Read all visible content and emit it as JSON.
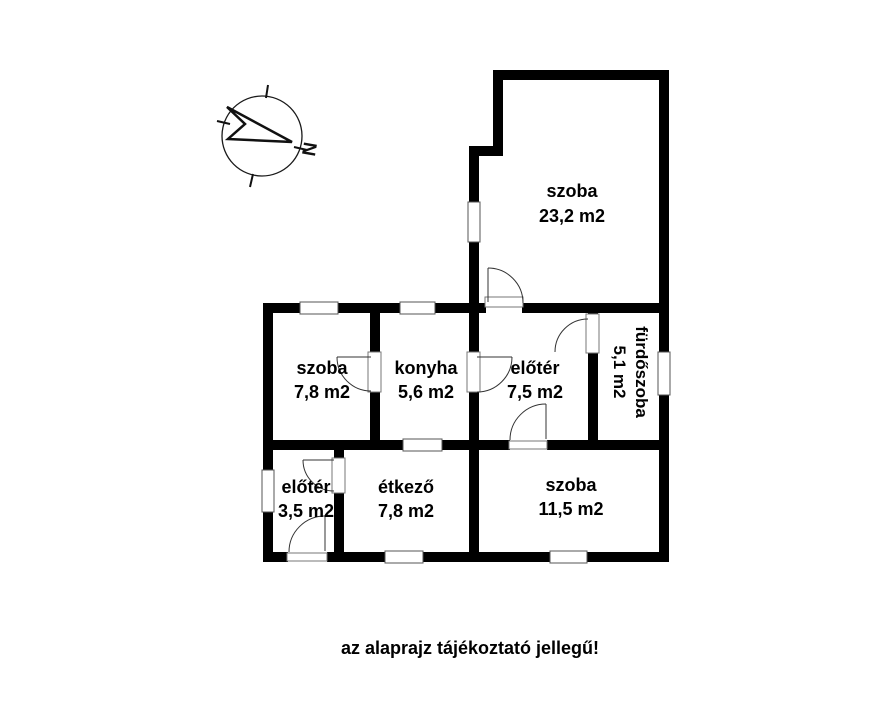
{
  "rooms": [
    {
      "id": "szoba-large",
      "name": "szoba",
      "area": "23,2 m2"
    },
    {
      "id": "szoba-small",
      "name": "szoba",
      "area": "7,8 m2"
    },
    {
      "id": "konyha",
      "name": "konyha",
      "area": "5,6 m2"
    },
    {
      "id": "eloter-upper",
      "name": "előtér",
      "area": "7,5 m2"
    },
    {
      "id": "furdoszoba",
      "name": "fürdőszoba",
      "area": "5,1 m2"
    },
    {
      "id": "eloter-lower",
      "name": "előtér",
      "area": "3,5 m2"
    },
    {
      "id": "etkezo",
      "name": "étkező",
      "area": "7,8 m2"
    },
    {
      "id": "szoba-bottom",
      "name": "szoba",
      "area": "11,5 m2"
    }
  ],
  "caption": "az alaprajz tájékoztató jellegű!",
  "compass": {
    "north_label": "N"
  },
  "colors": {
    "background": "#ffffff",
    "wall": "#000000",
    "text": "#000000",
    "window_outline": "#555555",
    "door_line": "#333333"
  }
}
